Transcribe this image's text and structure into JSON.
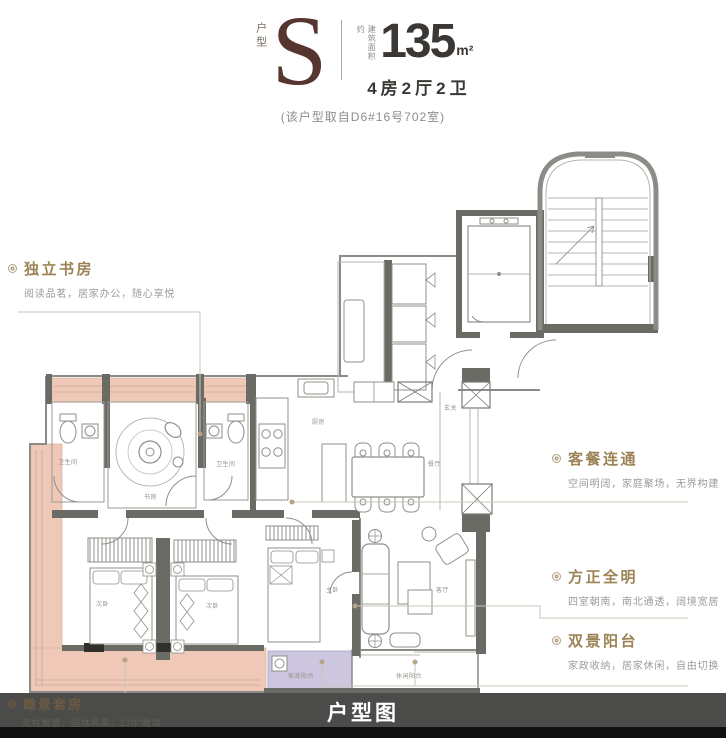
{
  "header": {
    "type_label": "户型",
    "type_letter": "S",
    "area_prefix": "建筑面积约",
    "area_value": "135",
    "area_unit": "m²",
    "layout_text": "4房2厅2卫",
    "source_note": "(该户型取自D6#16号702室)"
  },
  "annotations": {
    "study": {
      "title": "独立书房",
      "desc": "阅读品茗，居家办公，随心享悦"
    },
    "dining": {
      "title": "客餐连通",
      "desc": "空间明阔，家庭聚场，无界构建"
    },
    "bright": {
      "title": "方正全明",
      "desc": "四室朝南，南北通透，阔境宽居"
    },
    "balcony": {
      "title": "双景阳台",
      "desc": "家政收纳，居家休闲，自由切换"
    },
    "suite": {
      "title": "瞰景套房",
      "desc": "无柱飘窗，园林风景，270°瞰境"
    }
  },
  "plan": {
    "room_labels": {
      "bath_left": "卫生间",
      "bath_right": "卫生间",
      "study": "书房",
      "kitchen": "厨房",
      "dining": "餐厅",
      "foyer": "玄关",
      "living": "客厅",
      "master": "主卧",
      "bedroom_left": "次卧",
      "bedroom_mid": "次卧",
      "laundry_balcony": "家政阳台",
      "leisure_balcony": "休闲阳台"
    }
  },
  "footer": {
    "caption": "户型图"
  },
  "colors": {
    "accent_title": "#9c8355",
    "type_letter": "#57352f",
    "bay_window_pink": "#f0c8b7",
    "laundry_purple": "#ccc6df",
    "footer_band": "#4b4b49"
  }
}
